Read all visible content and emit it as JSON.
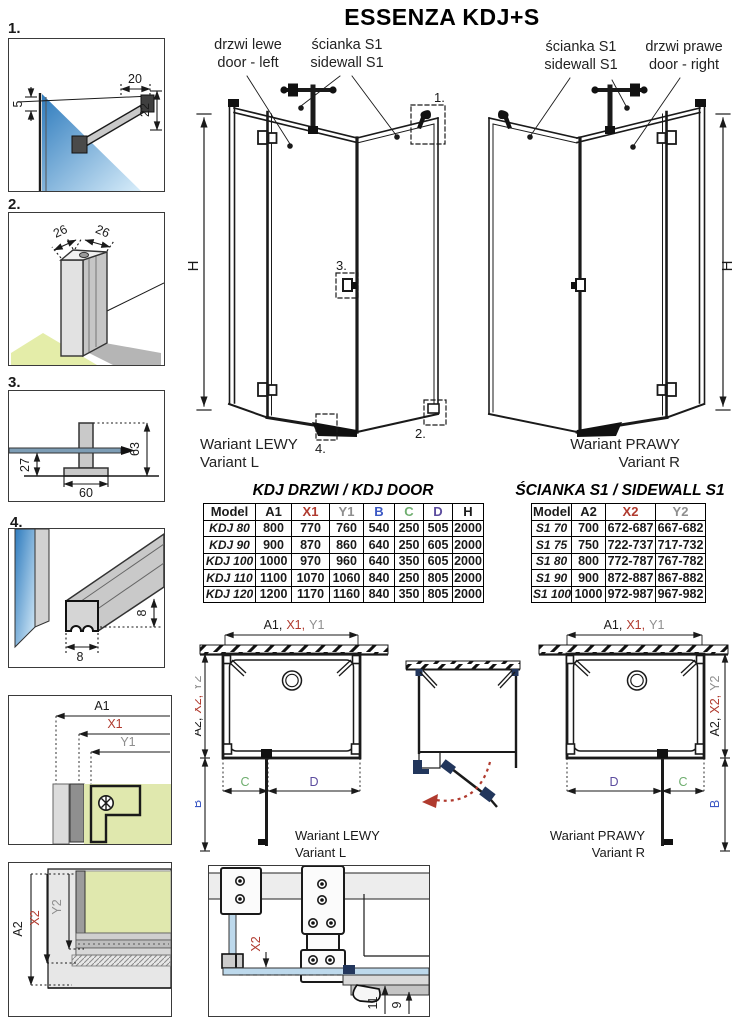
{
  "title": "ESSENZA KDJ+S",
  "labels": {
    "door_left_pl": "drzwi lewe",
    "door_left_en": "door - left",
    "sidewall_pl": "ścianka S1",
    "sidewall_en": "sidewall S1",
    "door_right_pl": "drzwi prawe",
    "door_right_en": "door - right",
    "variant_left_pl": "Wariant LEWY",
    "variant_left_en": "Variant L",
    "variant_right_pl": "Wariant PRAWY",
    "variant_right_en": "Variant R",
    "h": "H"
  },
  "callouts": {
    "c1": "1.",
    "c2": "2.",
    "c3": "3.",
    "c4": "4."
  },
  "dims": {
    "d1_top": "20",
    "d1_left": "5",
    "d1_right": "22",
    "d2_left": "26",
    "d2_right": "26",
    "d3_height": "63",
    "d3_left": "27",
    "d3_bottom": "60",
    "d4_right": "8",
    "d4_bottom": "8",
    "hinge_left": "11",
    "hinge_right": "9"
  },
  "axis": {
    "a1": "A1",
    "x1": "X1",
    "y1": "Y1",
    "a2": "A2",
    "x2": "X2",
    "y2": "Y2",
    "a1c": "A1,",
    "x1c": "X1,",
    "a2c": "A2,",
    "x2c": "X2,",
    "b": "B",
    "c": "C",
    "d": "D"
  },
  "door_table": {
    "title": "KDJ DRZWI / KDJ DOOR",
    "headers": [
      "Model",
      "A1",
      "X1",
      "Y1",
      "B",
      "C",
      "D",
      "H"
    ],
    "rows": [
      [
        "KDJ 80",
        "800",
        "770",
        "760",
        "540",
        "250",
        "505",
        "2000"
      ],
      [
        "KDJ 90",
        "900",
        "870",
        "860",
        "640",
        "250",
        "605",
        "2000"
      ],
      [
        "KDJ 100",
        "1000",
        "970",
        "960",
        "640",
        "350",
        "605",
        "2000"
      ],
      [
        "KDJ 110",
        "1100",
        "1070",
        "1060",
        "840",
        "250",
        "805",
        "2000"
      ],
      [
        "KDJ 120",
        "1200",
        "1170",
        "1160",
        "840",
        "350",
        "805",
        "2000"
      ]
    ]
  },
  "sidewall_table": {
    "title": "ŚCIANKA S1 / SIDEWALL S1",
    "headers": [
      "Model",
      "A2",
      "X2",
      "Y2"
    ],
    "rows": [
      [
        "S1 70",
        "700",
        "672-687",
        "667-682"
      ],
      [
        "S1 75",
        "750",
        "722-737",
        "717-732"
      ],
      [
        "S1 80",
        "800",
        "772-787",
        "767-782"
      ],
      [
        "S1 90",
        "900",
        "872-887",
        "867-882"
      ],
      [
        "S1 100",
        "1000",
        "972-987",
        "967-982"
      ]
    ]
  },
  "colors": {
    "accent_red": "#b03a2e",
    "dim_gray": "#8e8e8e",
    "dim_blue": "#3a57c4",
    "dim_green": "#6fae6f",
    "dim_purple": "#5b4b9e",
    "hardware_navy": "#22365c",
    "glass_blue": "#bdd9ec",
    "glass_green": "#e0e8ae"
  }
}
